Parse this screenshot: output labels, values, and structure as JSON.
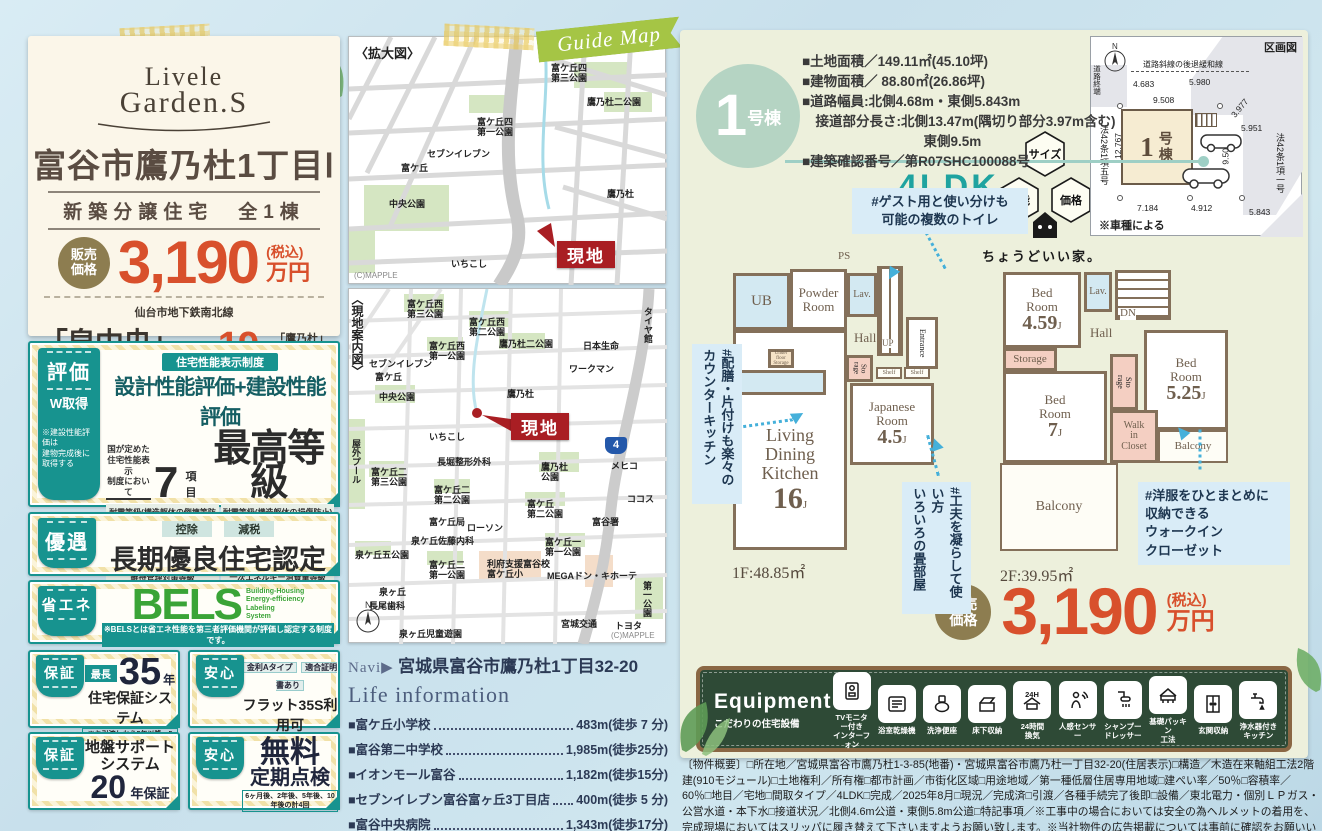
{
  "left": {
    "logo_top": "Livele",
    "logo_bottom": "Garden.S",
    "title": "富谷市鷹乃杜1丁目Ⅰ",
    "subtitle": "新築分譲住宅　全1棟",
    "price": {
      "label": "販売\n価格",
      "value": "3,190",
      "tax": "(税込)",
      "unit": "万円"
    },
    "access": {
      "rail": "仙台市地下鉄南北線",
      "station": "「泉中央」",
      "mode": "駅バス",
      "minutes": "19",
      "minutes_unit": "分",
      "stop": "「鷹乃杜」",
      "walk": "停歩6分"
    },
    "hyouka": {
      "tab": "評価",
      "tab2": "W取得",
      "tab_note": "※建設性能評価は\n建物完成後に\n取得する",
      "pill": "住宅性能表示制度",
      "heading": "設計性能評価+建設性能評価",
      "lead": "国が定めた\n住宅性能表示\n制度において",
      "num": "7",
      "num_unit": "項目",
      "grade": "最高等級",
      "items": [
        "耐震等級(構造躯体の倒壊等防止)",
        "耐震等級(構造躯体の損傷防止)",
        "耐風等級",
        "劣化対策等級",
        "ホルムアルデヒド等級(内装及び天井裏等)",
        "維持管理対策等級",
        "一次エネルギー消費量等級"
      ]
    },
    "yuuguu": {
      "tab": "優遇",
      "badge1": "控除",
      "badge2": "減税",
      "heading": "長期優良住宅認定物件",
      "note": "※一部の建物は対象外の場合があります。"
    },
    "shouene": {
      "tab": "省エネ",
      "bels": "BELS",
      "bels_sub": "Building-Housing\nEnergy-efficiency\nLabeling\nSystem",
      "note": "※BELSとは省エネ性能を第三者評価機関が評価し認定する制度です。"
    },
    "hosho35": {
      "tab": "保証",
      "pre": "最長",
      "num": "35",
      "unit": "年",
      "heading": "住宅保証システム",
      "note": "※お引渡しから5年以降、5年ごとに\n有償修繕工事を行うことが条件となります。"
    },
    "flat35": {
      "tab": "安心",
      "pill1": "金利Aタイプ",
      "pill2": "適合証明書あり",
      "heading": "フラット35S利用可",
      "note": "※一連の事務手数料として、物件引き渡し時に\n88,000円(税込)をお支払いいただきます。"
    },
    "jiban": {
      "tab": "保証",
      "head1": "地盤サポート",
      "head2": "システム",
      "num": "20",
      "unit": "年保証"
    },
    "tenken": {
      "tab": "安心",
      "head1": "無料",
      "head2": "定期点検",
      "note": "6ヶ月後、2年後、5年後、10年後の計4回"
    }
  },
  "maps": {
    "ribbon": "Guide Map",
    "compass": "N",
    "map1": {
      "title": "〈拡大図〉",
      "credit": "(C)MAPPLE",
      "genchi": "現地",
      "labels": [
        "富ケ丘四\n第三公園",
        "鷹乃杜二公園",
        "富ケ丘四\n第一公園",
        "セブンイレブン",
        "富ケ丘",
        "中央公園",
        "鷹乃杜",
        "いちこし"
      ]
    },
    "map2": {
      "title": "〈現地案内図〉",
      "credit": "(C)MAPPLE",
      "genchi": "現地",
      "route": "4",
      "labels": [
        "富ケ丘西\n第三公園",
        "富ケ丘西\n第二公園",
        "鷹乃杜二公園",
        "富ケ丘西\n第一公園",
        "セブンイレブン",
        "富ケ丘",
        "中央公園",
        "鷹乃杜",
        "いちこし",
        "長堀整形外科",
        "鷹乃杜\n公園",
        "タイヤ館",
        "日本生命",
        "ワークマン",
        "メヒコ",
        "ココス",
        "富谷署",
        "富ケ丘二\n第三公園",
        "富ケ丘二\n第二公園",
        "富ケ丘\n第二公園",
        "富ケ丘局",
        "ローソン",
        "泉ケ丘佐藤内科",
        "泉ケ丘五公園",
        "富ケ丘二\n第一公園",
        "富ケ丘一\n第一公園",
        "利府支援富谷校\n富ケ丘小",
        "MEGAドン・キホーテ",
        "泉ヶ丘",
        "長尾歯科",
        "泉ヶ丘児童遊園",
        "宮城交通",
        "トヨタ",
        "第一公園",
        "屋外プール"
      ]
    }
  },
  "navi": {
    "label": "Navi▶",
    "address": "宮城県富谷市鷹乃杜1丁目32-20"
  },
  "life": {
    "title": "Life information",
    "items": [
      {
        "name": "■富ケ丘小学校",
        "dist": "483m(徒歩 7 分)"
      },
      {
        "name": "■富谷第二中学校",
        "dist": "1,985m(徒歩25分)"
      },
      {
        "name": "■イオンモール富谷",
        "dist": "1,182m(徒歩15分)"
      },
      {
        "name": "■セブンイレブン富谷富ヶ丘3丁目店",
        "dist": "400m(徒歩 5 分)"
      },
      {
        "name": "■富谷中央病院",
        "dist": "1,343m(徒歩17分)"
      },
      {
        "name": "■富谷富ケ丘郵便局",
        "dist": "590m(徒歩 8 分)"
      }
    ]
  },
  "unit": {
    "badge_num": "1",
    "badge_suffix": "号棟",
    "specs": "■土地面積／149.11㎡(45.10坪)\n■建物面積／ 88.80㎡(26.86坪)\n■道路幅員:北側4.68m・東側5.843m\n　接道部分長さ:北側13.47m(隅切り部分3.97m含む)\n　　　　　　　　　東側9.5m\n■建築確認番号／第R07SHC100088号",
    "ldk": "4LDK",
    "hex": {
      "top": "サイズ",
      "left": "性能",
      "right": "価格",
      "tagline": "ちょうどいい家。"
    },
    "price": {
      "label": "販売\n価格",
      "value": "3,190",
      "tax": "(税込)",
      "unit": "万円"
    }
  },
  "kukaku": {
    "title": "区画図",
    "setback": "道路斜線の後退緩和線",
    "road_end": "道路終端",
    "law_left": "法42条1項五号",
    "law_right": "法42条1項一号",
    "house_num": "1",
    "house_suffix": "号棟",
    "d_top1": "4.683",
    "d_top2": "5.980",
    "d_top3": "9.508",
    "d_diag": "3.977",
    "d_right1": "5.951",
    "d_left": "12.767",
    "d_mid": "9.503",
    "d_b1": "7.184",
    "d_b2": "4.912",
    "d_b3": "5.843",
    "note": "※車種による"
  },
  "plan1": {
    "ps": "PS",
    "ub": "UB",
    "powder": "Powder\nRoom",
    "lav": "Lav.",
    "hall": "Hall",
    "up": "UP",
    "entrance": "Entrance",
    "storage": "Sto\nrage",
    "shelf1": "Shelf",
    "shelf2": "Shelf",
    "ufs": "Under\nfloor\nStorage",
    "jname": "Japanese\nRoom",
    "jsize": "4.5",
    "jsize_u": "J",
    "ldk": "Living\nDining\nKitchen",
    "ldk_size": "16",
    "ldk_u": "J",
    "caption": "1F:48.85㎡"
  },
  "plan2": {
    "bed1": "Bed\nRoom",
    "bed1_size": "4.59",
    "bed1_u": "J",
    "lav": "Lav.",
    "dn": "DN",
    "hall": "Hall",
    "storage": "Storage",
    "storage2": "Sto\nrage",
    "bed2": "Bed\nRoom",
    "bed2_size": "7",
    "bed2_u": "J",
    "bed3": "Bed\nRoom",
    "bed3_size": "5.25",
    "bed3_u": "J",
    "wic": "Walk\nin\nCloset",
    "balcony1": "Balcony",
    "balcony2": "Balcony",
    "caption": "2F:39.95㎡"
  },
  "notes": {
    "toilet": "#ゲスト用と使い分けも\n可能の複数のトイレ",
    "kitchen": "#配膳・片付けも楽々の\nカウンターキッチン",
    "tatami": "#工夫を凝らして使い方\nいろいろの畳部屋",
    "wic": "#洋服をひとまとめに\n収納できる\nウォークイン\nクローゼット"
  },
  "equipment": {
    "title": "Equipment",
    "subtitle": "こだわりの住宅設備",
    "icon24h": "24H",
    "items": [
      "TVモニター付き\nインターフォン",
      "浴室乾燥機",
      "洗浄便座",
      "床下収納",
      "24時間\n換気",
      "人感センサー",
      "シャンプー\nドレッサー",
      "基礎パッキン\n工法",
      "玄関収納",
      "浄水器付き\nキッチン"
    ]
  },
  "overview": "〔物件概要〕□所在地／宮城県富谷市鷹乃杜1-3-85(地番)・宮城県富谷市鷹乃杜一丁目32-20(住居表示)□構造／木造在来軸組工法2階建(910モジュール)□土地権利／所有権□都市計画／市街化区域□用途地域／第一種低層住居専用地域□建ぺい率／50％□容積率／60％□地目／宅地□間取タイプ／4LDK□完成／2025年8月□現況／完成済□引渡／各種手続完了後即□設備／東北電力・個別ＬＰガス・公営水道・本下水□接道状況／北側4.6m公道・東側5.8m公道□特記事項／※工事中の場合においては安全の為ヘルメットの着用を、完成現場においてはスリッパに履き替えて下さいますようお願い致します。※当社物件の広告掲載については事前に確認をお願いいたします。※〇網戸・照明器具・アンテナ等はオプションとなります。※図面と現況が相違する場合は現況優先とします。※当社標準工事以外の工事は全て別途工事代金が掛かります。※全棟が長期優良住宅対象物件です。広告有効期限／2025年11月30日"
}
